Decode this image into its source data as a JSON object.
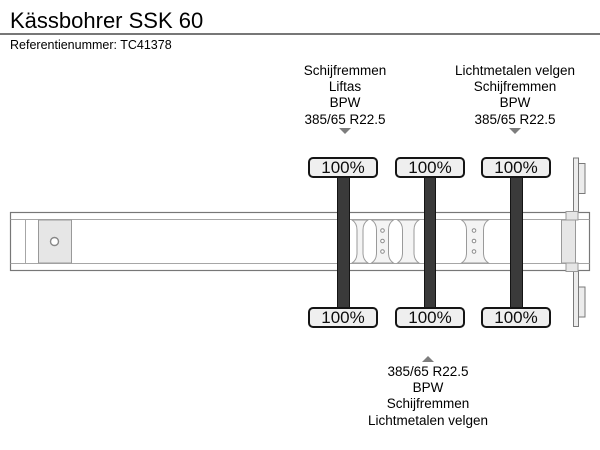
{
  "header": {
    "title": "Kässbohrer SSK 60",
    "reference": "Referentienummer: TC41378"
  },
  "annotations": {
    "front_axle_group": {
      "pointer_icon": "arrow-down",
      "lines": [
        "Schijfremmen",
        "Liftas",
        "BPW",
        "385/65 R22.5"
      ]
    },
    "rear_axle_group": {
      "pointer_icon": "arrow-down",
      "lines": [
        "Lichtmetalen velgen",
        "Schijfremmen",
        "BPW",
        "385/65 R22.5"
      ]
    },
    "bottom_axle_group": {
      "pointer_icon": "arrow-up",
      "lines": [
        "385/65 R22.5",
        "BPW",
        "Schijfremmen",
        "Lichtmetalen velgen"
      ]
    }
  },
  "diagram": {
    "type": "trailer-side-view",
    "axles": [
      {
        "name": "axle-1",
        "top_load": "100%",
        "bottom_load": "100%"
      },
      {
        "name": "axle-2",
        "top_load": "100%",
        "bottom_load": "100%"
      },
      {
        "name": "axle-3",
        "top_load": "100%",
        "bottom_load": "100%"
      }
    ]
  },
  "colors": {
    "background": "#ffffff",
    "text": "#111111",
    "beam_outline": "#777777",
    "beam_inner_line": "#a6a6a6",
    "plate_fill": "#e6e6e6",
    "bracket_fill": "#f4f4f4",
    "tire_bar": "#3a3a3a",
    "tire_bar_edge": "#141414",
    "label_fill": "#efefef",
    "label_border": "#151515",
    "arrow": "#7d7d7d",
    "divider": "#777777"
  }
}
